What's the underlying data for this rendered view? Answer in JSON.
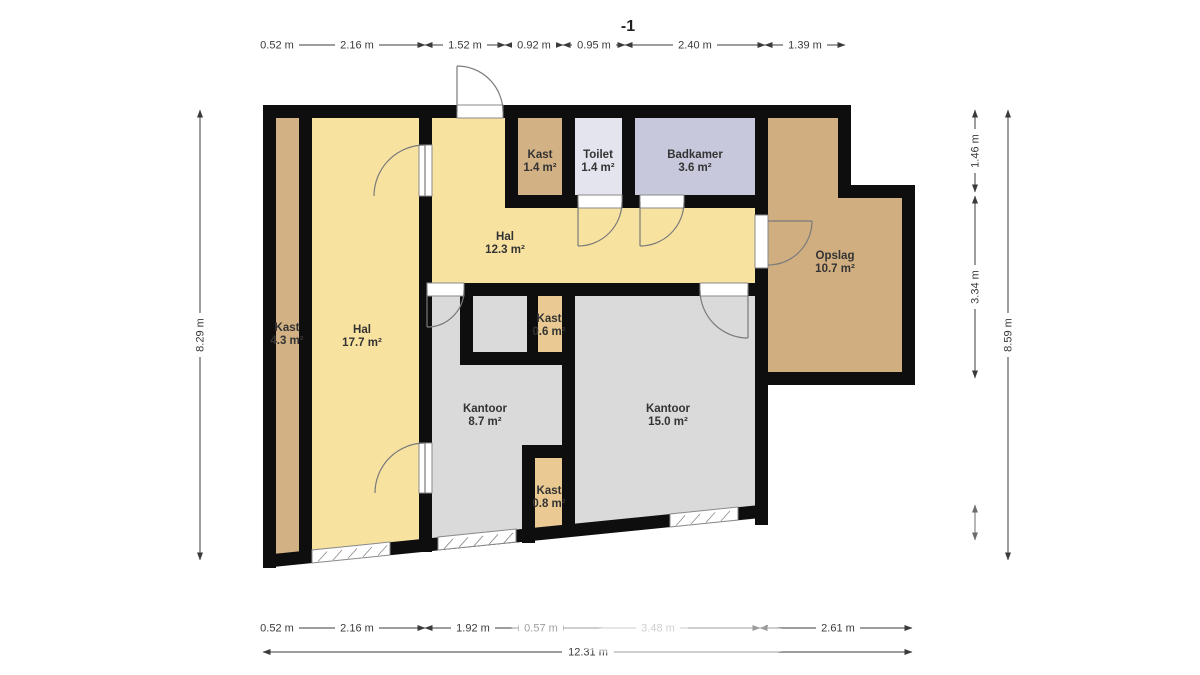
{
  "title": "-1",
  "colors": {
    "wall": "#0e0e0e",
    "kantoor_gray": "#dadada",
    "hal_yellow": "#f8e2a0",
    "kast_tan": "#d2b184",
    "kast_light": "#eaca92",
    "opslag_tan": "#d0ae80",
    "toilet": "#e4e4ee",
    "badkamer": "#c8c8dd"
  },
  "rooms": [
    {
      "name": "Kast",
      "area": "4.3 m²",
      "color": "#d2b184"
    },
    {
      "name": "Hal",
      "area": "17.7 m²",
      "color": "#f8e2a0"
    },
    {
      "name": "Hal",
      "area": "12.3 m²",
      "color": "#f8e2a0"
    },
    {
      "name": "Kast",
      "area": "1.4 m²",
      "color": "#d2b184"
    },
    {
      "name": "Toilet",
      "area": "1.4 m²",
      "color": "#e4e4ee"
    },
    {
      "name": "Badkamer",
      "area": "3.6 m²",
      "color": "#c8c8dd"
    },
    {
      "name": "Opslag",
      "area": "10.7 m²",
      "color": "#d0ae80"
    },
    {
      "name": "Kast",
      "area": "0.6 m²",
      "color": "#eaca92"
    },
    {
      "name": "Kantoor",
      "area": "8.7 m²",
      "color": "#dadada"
    },
    {
      "name": "Kantoor",
      "area": "15.0 m²",
      "color": "#dadada"
    },
    {
      "name": "Kast",
      "area": "0.8 m²",
      "color": "#eaca92"
    }
  ],
  "dims": {
    "top": [
      "0.52 m",
      "2.16 m",
      "1.52 m",
      "0.92 m",
      "0.95 m",
      "2.40 m",
      "1.39 m"
    ],
    "bottom": [
      "0.52 m",
      "2.16 m",
      "1.92 m",
      "0.57 m",
      "3.48 m",
      "2.61 m"
    ],
    "bottom_total": "12.31 m",
    "left_total": "8.29 m",
    "right": [
      "1.46 m",
      "3.34 m"
    ],
    "right_total": "8.59 m"
  }
}
